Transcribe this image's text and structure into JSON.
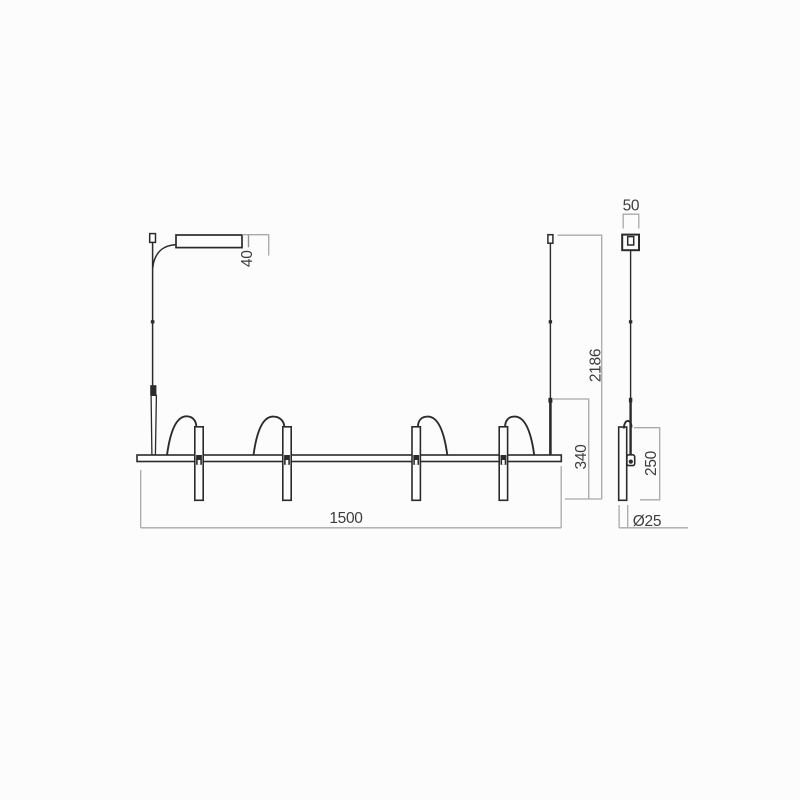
{
  "dimensions": {
    "bar_length": "1500",
    "overall_height": "2186",
    "suspension_to_bar": "340",
    "tube_length": "250",
    "canopy_height": "40",
    "canopy_width": "50",
    "tube_diameter": "Ø25"
  },
  "colors": {
    "line": "#2b2b2b",
    "dimension_line": "#a9a9a9",
    "text": "#3d3d3d",
    "background": "#fcfcfc"
  }
}
